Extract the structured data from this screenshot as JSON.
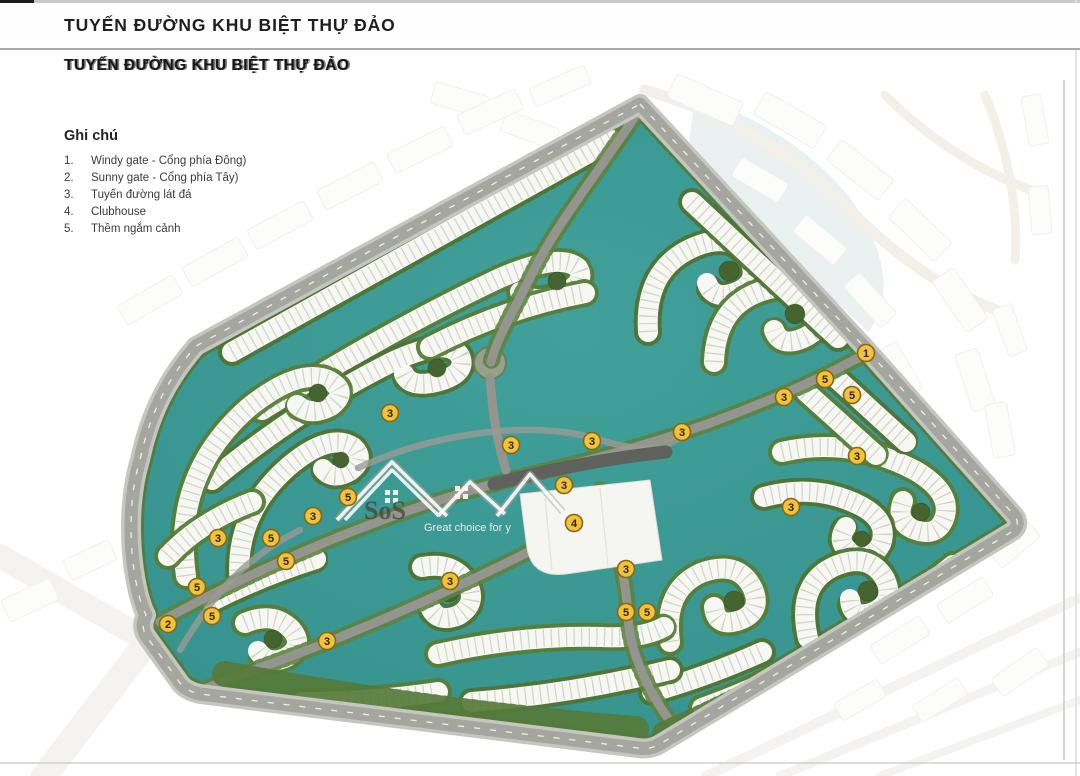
{
  "page": {
    "header_title": "TUYẾN ĐƯỜNG KHU BIỆT THỰ ĐẢO",
    "subheader_title": "TUYẾN ĐƯỜNG KHU BIỆT THỰ ĐẢO"
  },
  "legend": {
    "title": "Ghi chú",
    "items": [
      {
        "num": "1.",
        "label": "Windy gate - Cổng phía Đông)"
      },
      {
        "num": "2.",
        "label": "Sunny gate - Cổng phía Tây)"
      },
      {
        "num": "3.",
        "label": "Tuyến đường lát đá"
      },
      {
        "num": "4.",
        "label": "Clubhouse"
      },
      {
        "num": "5.",
        "label": "Thềm ngắm cảnh"
      }
    ]
  },
  "watermark": {
    "brand": "SoS",
    "tagline": "Great choice for y"
  },
  "map": {
    "colors": {
      "water": "#3B9894",
      "villa": "#F7F8F3",
      "tree": "#45642F",
      "road": "#94958E",
      "paved_road_dark": "#5F615C",
      "marker_fill": "#F1C23B",
      "marker_border": "#8A6614"
    },
    "markers": [
      {
        "x": 866,
        "y": 353,
        "label": "1"
      },
      {
        "x": 168,
        "y": 624,
        "label": "2"
      },
      {
        "x": 390,
        "y": 413,
        "label": "3"
      },
      {
        "x": 511,
        "y": 445,
        "label": "3"
      },
      {
        "x": 592,
        "y": 441,
        "label": "3"
      },
      {
        "x": 682,
        "y": 432,
        "label": "3"
      },
      {
        "x": 784,
        "y": 397,
        "label": "3"
      },
      {
        "x": 857,
        "y": 456,
        "label": "3"
      },
      {
        "x": 564,
        "y": 485,
        "label": "3"
      },
      {
        "x": 313,
        "y": 516,
        "label": "3"
      },
      {
        "x": 791,
        "y": 507,
        "label": "3"
      },
      {
        "x": 218,
        "y": 538,
        "label": "3"
      },
      {
        "x": 450,
        "y": 581,
        "label": "3"
      },
      {
        "x": 626,
        "y": 569,
        "label": "3"
      },
      {
        "x": 327,
        "y": 641,
        "label": "3"
      },
      {
        "x": 574,
        "y": 523,
        "label": "4"
      },
      {
        "x": 825,
        "y": 379,
        "label": "5"
      },
      {
        "x": 852,
        "y": 395,
        "label": "5"
      },
      {
        "x": 348,
        "y": 497,
        "label": "5"
      },
      {
        "x": 271,
        "y": 538,
        "label": "5"
      },
      {
        "x": 286,
        "y": 561,
        "label": "5"
      },
      {
        "x": 197,
        "y": 587,
        "label": "5"
      },
      {
        "x": 212,
        "y": 616,
        "label": "5"
      },
      {
        "x": 626,
        "y": 612,
        "label": "5"
      },
      {
        "x": 647,
        "y": 612,
        "label": "5"
      }
    ]
  }
}
